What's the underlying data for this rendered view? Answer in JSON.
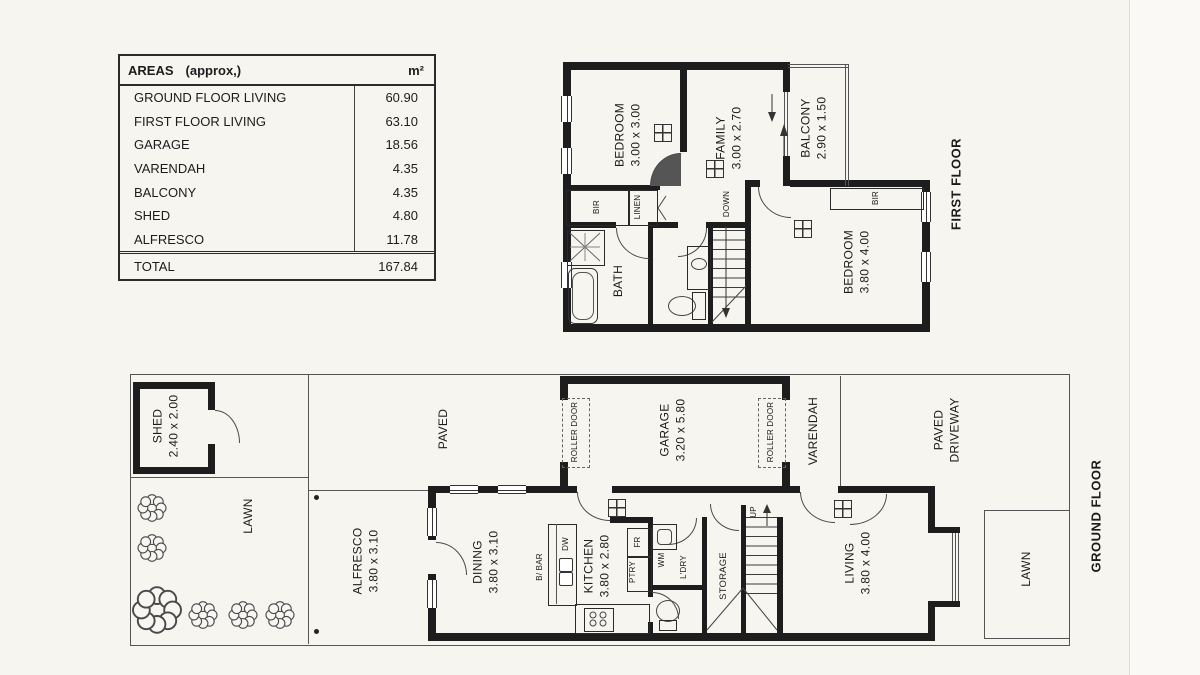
{
  "sheet": {
    "bg": "#f7f5f0",
    "ink": "#1c1c1c",
    "wall_color": "#1d1d1d"
  },
  "areas_table": {
    "title": "AREAS",
    "title_suffix": "(approx,)",
    "unit": "m²",
    "rows": [
      {
        "label": "GROUND FLOOR LIVING",
        "value": "60.90"
      },
      {
        "label": "FIRST FLOOR LIVING",
        "value": "63.10"
      },
      {
        "label": "GARAGE",
        "value": "18.56"
      },
      {
        "label": "VARENDAH",
        "value": "4.35"
      },
      {
        "label": "BALCONY",
        "value": "4.35"
      },
      {
        "label": "SHED",
        "value": "4.80"
      },
      {
        "label": "ALFRESCO",
        "value": "11.78"
      }
    ],
    "total": {
      "label": "TOTAL",
      "value": "167.84"
    }
  },
  "first_floor": {
    "caption": "FIRST FLOOR",
    "rooms": {
      "bedroom1": {
        "name": "BEDROOM",
        "dims": "3.00 x 3.00"
      },
      "family": {
        "name": "FAMILY",
        "dims": "3.00 x 2.70"
      },
      "balcony": {
        "name": "BALCONY",
        "dims": "2.90 x 1.50"
      },
      "bedroom2": {
        "name": "BEDROOM",
        "dims": "3.80 x 4.00"
      },
      "bath": {
        "name": "BATH"
      }
    },
    "labels": {
      "bir": "BIR",
      "linen": "LINEN",
      "down": "DOWN"
    }
  },
  "ground_floor": {
    "caption": "GROUND FLOOR",
    "rooms": {
      "shed": {
        "name": "SHED",
        "dims": "2.40 x 2.00"
      },
      "garage": {
        "name": "GARAGE",
        "dims": "3.20 x 5.80"
      },
      "dining": {
        "name": "DINING",
        "dims": "3.80 x 3.10"
      },
      "kitchen": {
        "name": "KITCHEN",
        "dims": "3.80 x 2.80"
      },
      "living": {
        "name": "LIVING",
        "dims": "3.80 x 4.00"
      },
      "alfresco": {
        "name": "ALFRESCO",
        "dims": "3.80 x 3.10"
      }
    },
    "labels": {
      "lawn": "LAWN",
      "paved": "PAVED",
      "paved_driveway_1": "PAVED",
      "paved_driveway_2": "DRIVEWAY",
      "roller_door": "ROLLER DOOR",
      "varendah": "VARENDAH",
      "storage": "STORAGE",
      "ldry": "L'DRY",
      "up": "UP",
      "bbar": "B/ BAR",
      "dw": "DW",
      "fr": "FR",
      "ptry": "PTRY",
      "wm": "WM"
    }
  }
}
